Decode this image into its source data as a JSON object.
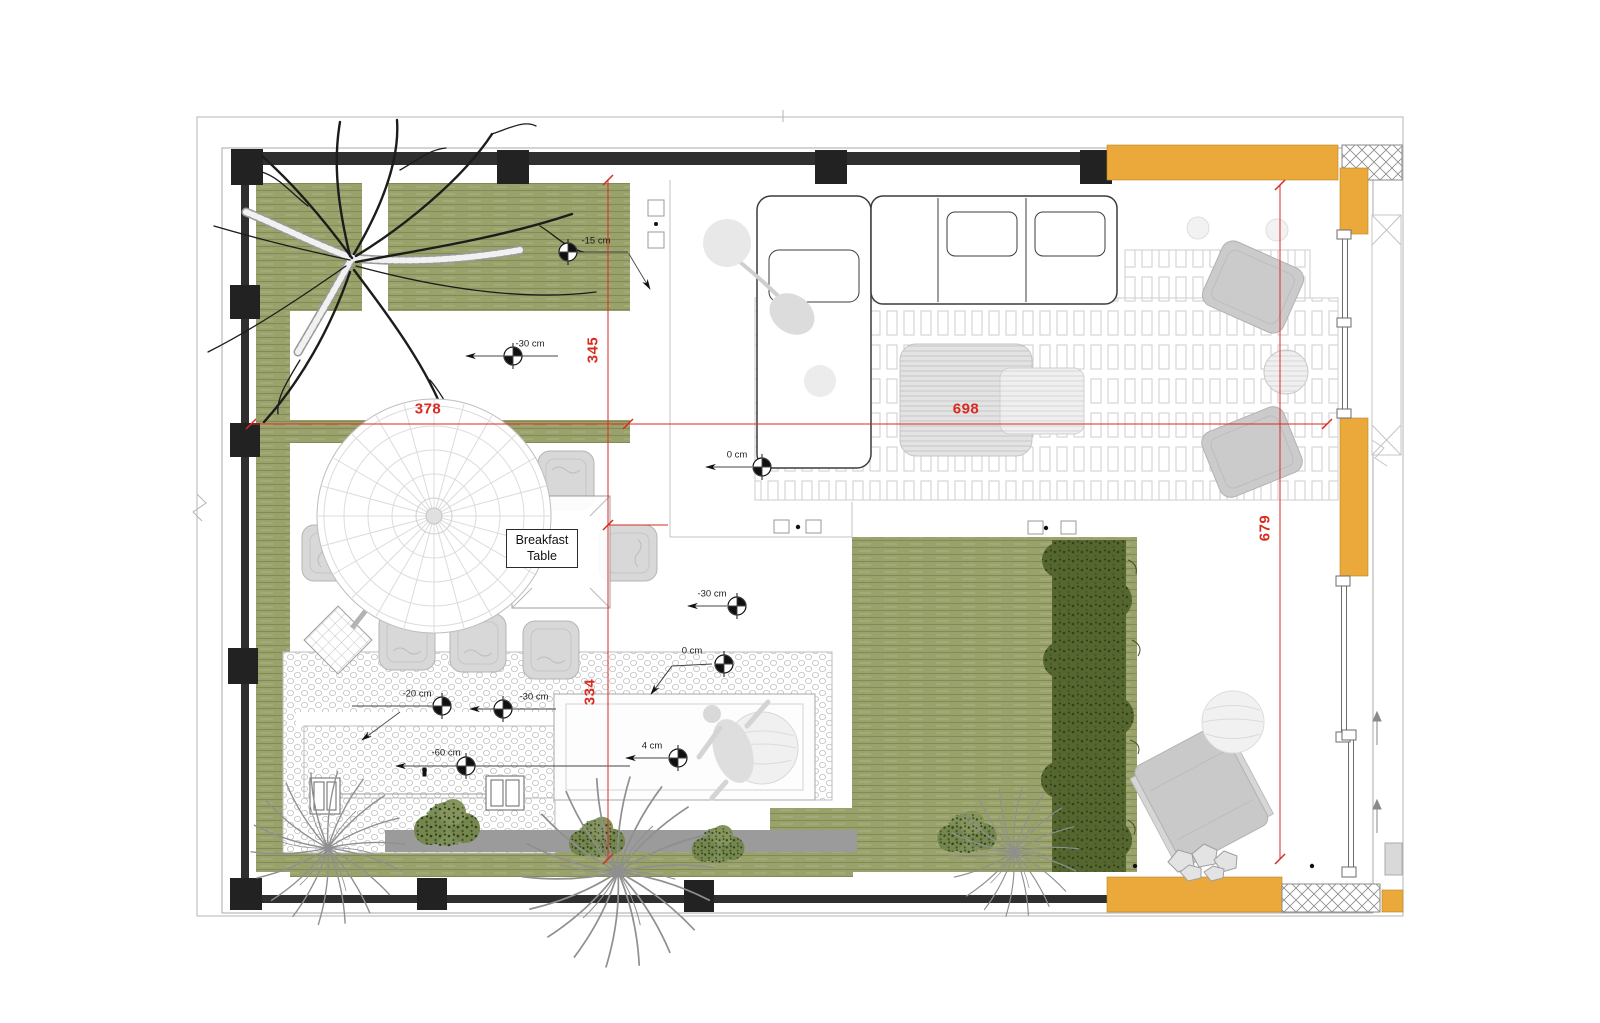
{
  "plan": {
    "room_label": {
      "line1": "Breakfast",
      "line2": "Table"
    },
    "dimensions": {
      "terrace_width": "378",
      "living_width": "698",
      "terrace_height_upper": "345",
      "terrace_height_lower": "334",
      "living_height": "679"
    },
    "level_markers": [
      {
        "label": "-15 cm"
      },
      {
        "label": "-30 cm"
      },
      {
        "label": "0 cm"
      },
      {
        "label": "-30 cm"
      },
      {
        "label": "0 cm"
      },
      {
        "label": "4 cm"
      },
      {
        "label": "-20 cm"
      },
      {
        "label": "-30 cm"
      },
      {
        "label": "-60 cm"
      }
    ],
    "colors": {
      "accent_yellow": "#EBA83B",
      "dimension_red": "#D92B21",
      "lawn_green": "#99A26A",
      "hedge_green": "#55662F"
    }
  }
}
